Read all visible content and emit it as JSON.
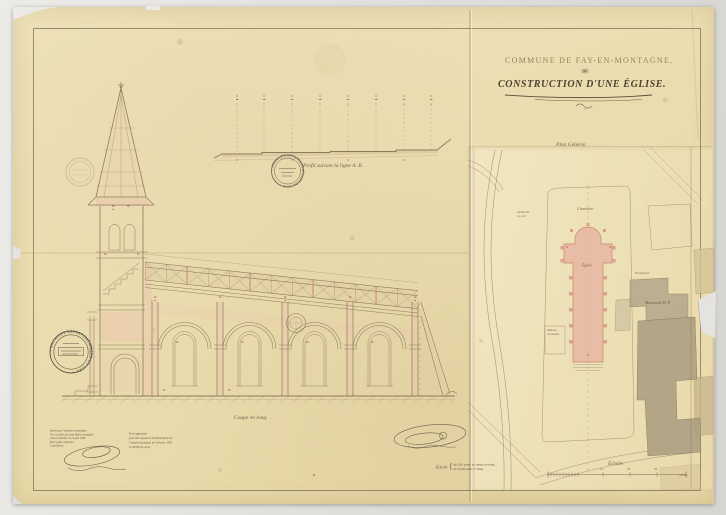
{
  "titleblock": {
    "commune": "COMMUNE DE FAY-EN-MONTAGNE.",
    "title": "CONSTRUCTION D'UNE ÉGLISE."
  },
  "captions": {
    "profile": "Profil suivant la ligne A. B.",
    "section": "Coupe en long.",
    "plan_title": "Plan Général",
    "scale_word": "Échelle",
    "scale_brace": "{",
    "scale_line1": "de 0,01 pour la coupe en long,",
    "scale_line2": "de 0,002 pour le Plan."
  },
  "plan": {
    "cemetery_label": "Cimetière",
    "church_label": "Église",
    "left_parcel_line1": "Jardin de",
    "left_parcel_line2": "la cure",
    "presbytery_label": "Presbytère",
    "house_label": "Maison de M. P.",
    "small_parcel_line1": "Maison",
    "small_parcel_line2": "commune",
    "scale_label": "Échelle",
    "scale_ticks": [
      "10",
      "20",
      "30"
    ],
    "scale_unit": "mètres"
  },
  "annotations": {
    "left": [
      "Dressé par l'architecte soussigné,",
      "Vu et certifié par nous Maire soussigné,",
      "Lons-le-Saunier, le 24 juin 1838.",
      "Pour copie conforme :",
      "L'architecte,"
    ],
    "right": [
      "Vu et approuvé,",
      "pour être annexé à la délibération du",
      "Conseil municipal, du 4 février 1839.",
      "Le Préfet du Jura,"
    ]
  },
  "stamps": {
    "rim_text": "• ARCHIVES DÉPARTEMENTALES DU JURA •"
  }
}
